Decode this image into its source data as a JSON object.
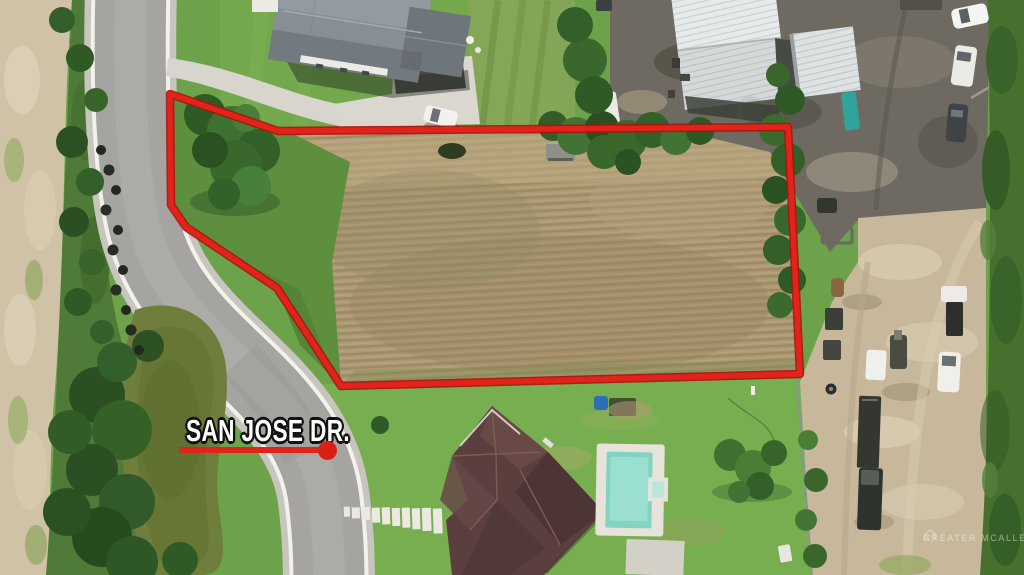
{
  "street_label": {
    "text": "SAN JOSE DR."
  },
  "watermark": {
    "text": "GREATER MCALLEN"
  },
  "colors": {
    "boundary_red": "#e2231a",
    "boundary_red_dark": "#a81410",
    "label_text": "#ffffff",
    "label_outline": "#121212",
    "pool_water": "#8fd8c6",
    "pond_water": "#6f7d3d"
  }
}
